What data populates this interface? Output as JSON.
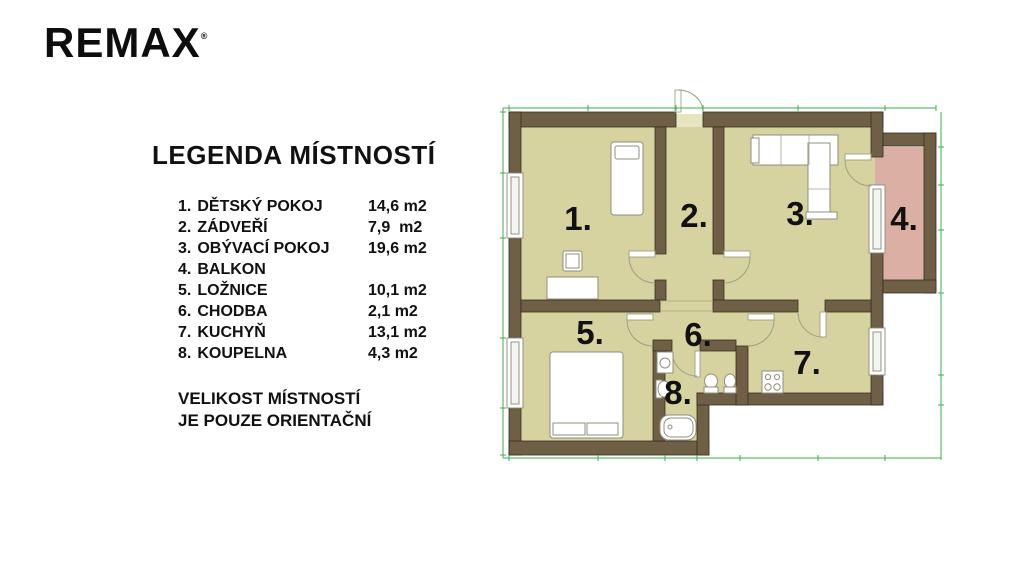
{
  "brand": {
    "logo_text": "REMAX",
    "trademark": "®"
  },
  "legend": {
    "title": "LEGENDA MÍSTNOSTÍ",
    "rows": [
      {
        "num": "1.",
        "name": "DĚTSKÝ POKOJ",
        "area": "14,6 m2"
      },
      {
        "num": "2.",
        "name": "ZÁDVEŘÍ",
        "area": "7,9  m2"
      },
      {
        "num": "3.",
        "name": "OBÝVACÍ POKOJ",
        "area": "19,6 m2"
      },
      {
        "num": "4.",
        "name": "BALKON",
        "area": ""
      },
      {
        "num": "5.",
        "name": "LOŽNICE",
        "area": "10,1 m2"
      },
      {
        "num": "6.",
        "name": "CHODBA",
        "area": "2,1 m2"
      },
      {
        "num": "7.",
        "name": "KUCHYŇ",
        "area": "13,1 m2"
      },
      {
        "num": "8.",
        "name": "KOUPELNA",
        "area": "4,3 m2"
      }
    ],
    "note": [
      "VELIKOST MÍSTNOSTÍ",
      "JE POUZE ORIENTAČNÍ"
    ]
  },
  "plan": {
    "room_labels": [
      {
        "label": "1."
      },
      {
        "label": "2."
      },
      {
        "label": "3."
      },
      {
        "label": "4."
      },
      {
        "label": "5."
      },
      {
        "label": "6."
      },
      {
        "label": "7."
      },
      {
        "label": "8."
      }
    ],
    "colors": {
      "wall": "#6e5f46",
      "room_fill": "#d6d3a1",
      "balcony_fill": "#dcafa4",
      "dimension_line": "#3fae4e",
      "label_text": "#111111"
    }
  }
}
